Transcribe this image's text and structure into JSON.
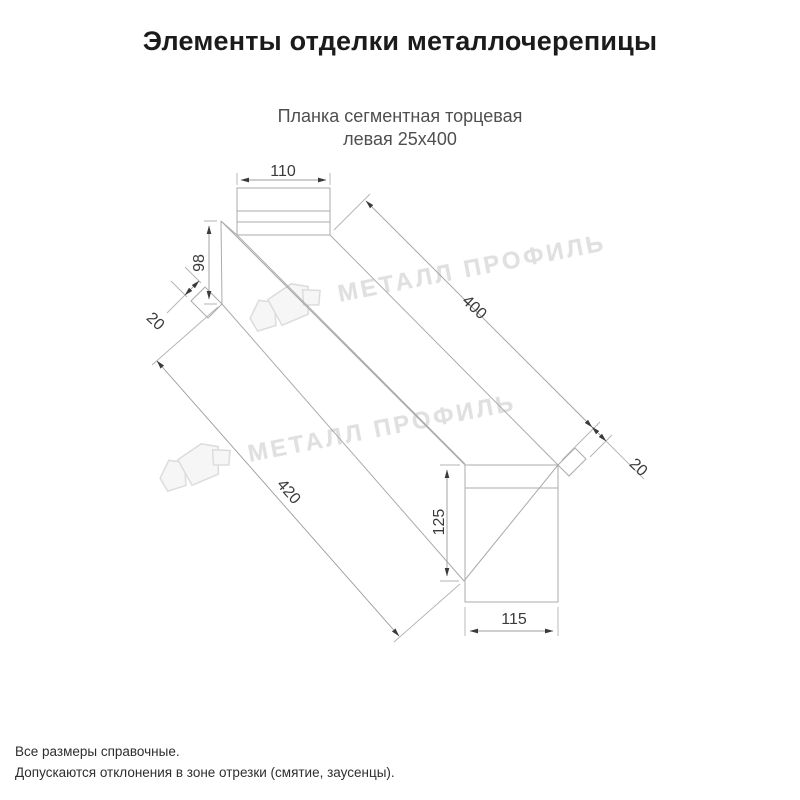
{
  "page": {
    "title": "Элементы отделки металлочерепицы"
  },
  "product": {
    "name_line1": "Планка сегментная торцевая",
    "name_line2": "левая 25х400"
  },
  "dimensions": {
    "top_width": "110",
    "left_height": "98",
    "left_hem": "20",
    "length_top": "400",
    "right_hem": "20",
    "length_bottom": "420",
    "end_height": "125",
    "end_width": "115"
  },
  "watermark": {
    "brand": "МЕТАЛЛ ПРОФИЛЬ"
  },
  "notes": {
    "line1": "Все размеры справочные.",
    "line2": "Допускаются отклонения в зоне отрезки (смятие, заусенцы)."
  },
  "colors": {
    "part_outline": "#ababab",
    "dimension_line": "#9c9c9c",
    "dimension_text": "#3a3a3a",
    "watermark": "#e0e0e0"
  }
}
